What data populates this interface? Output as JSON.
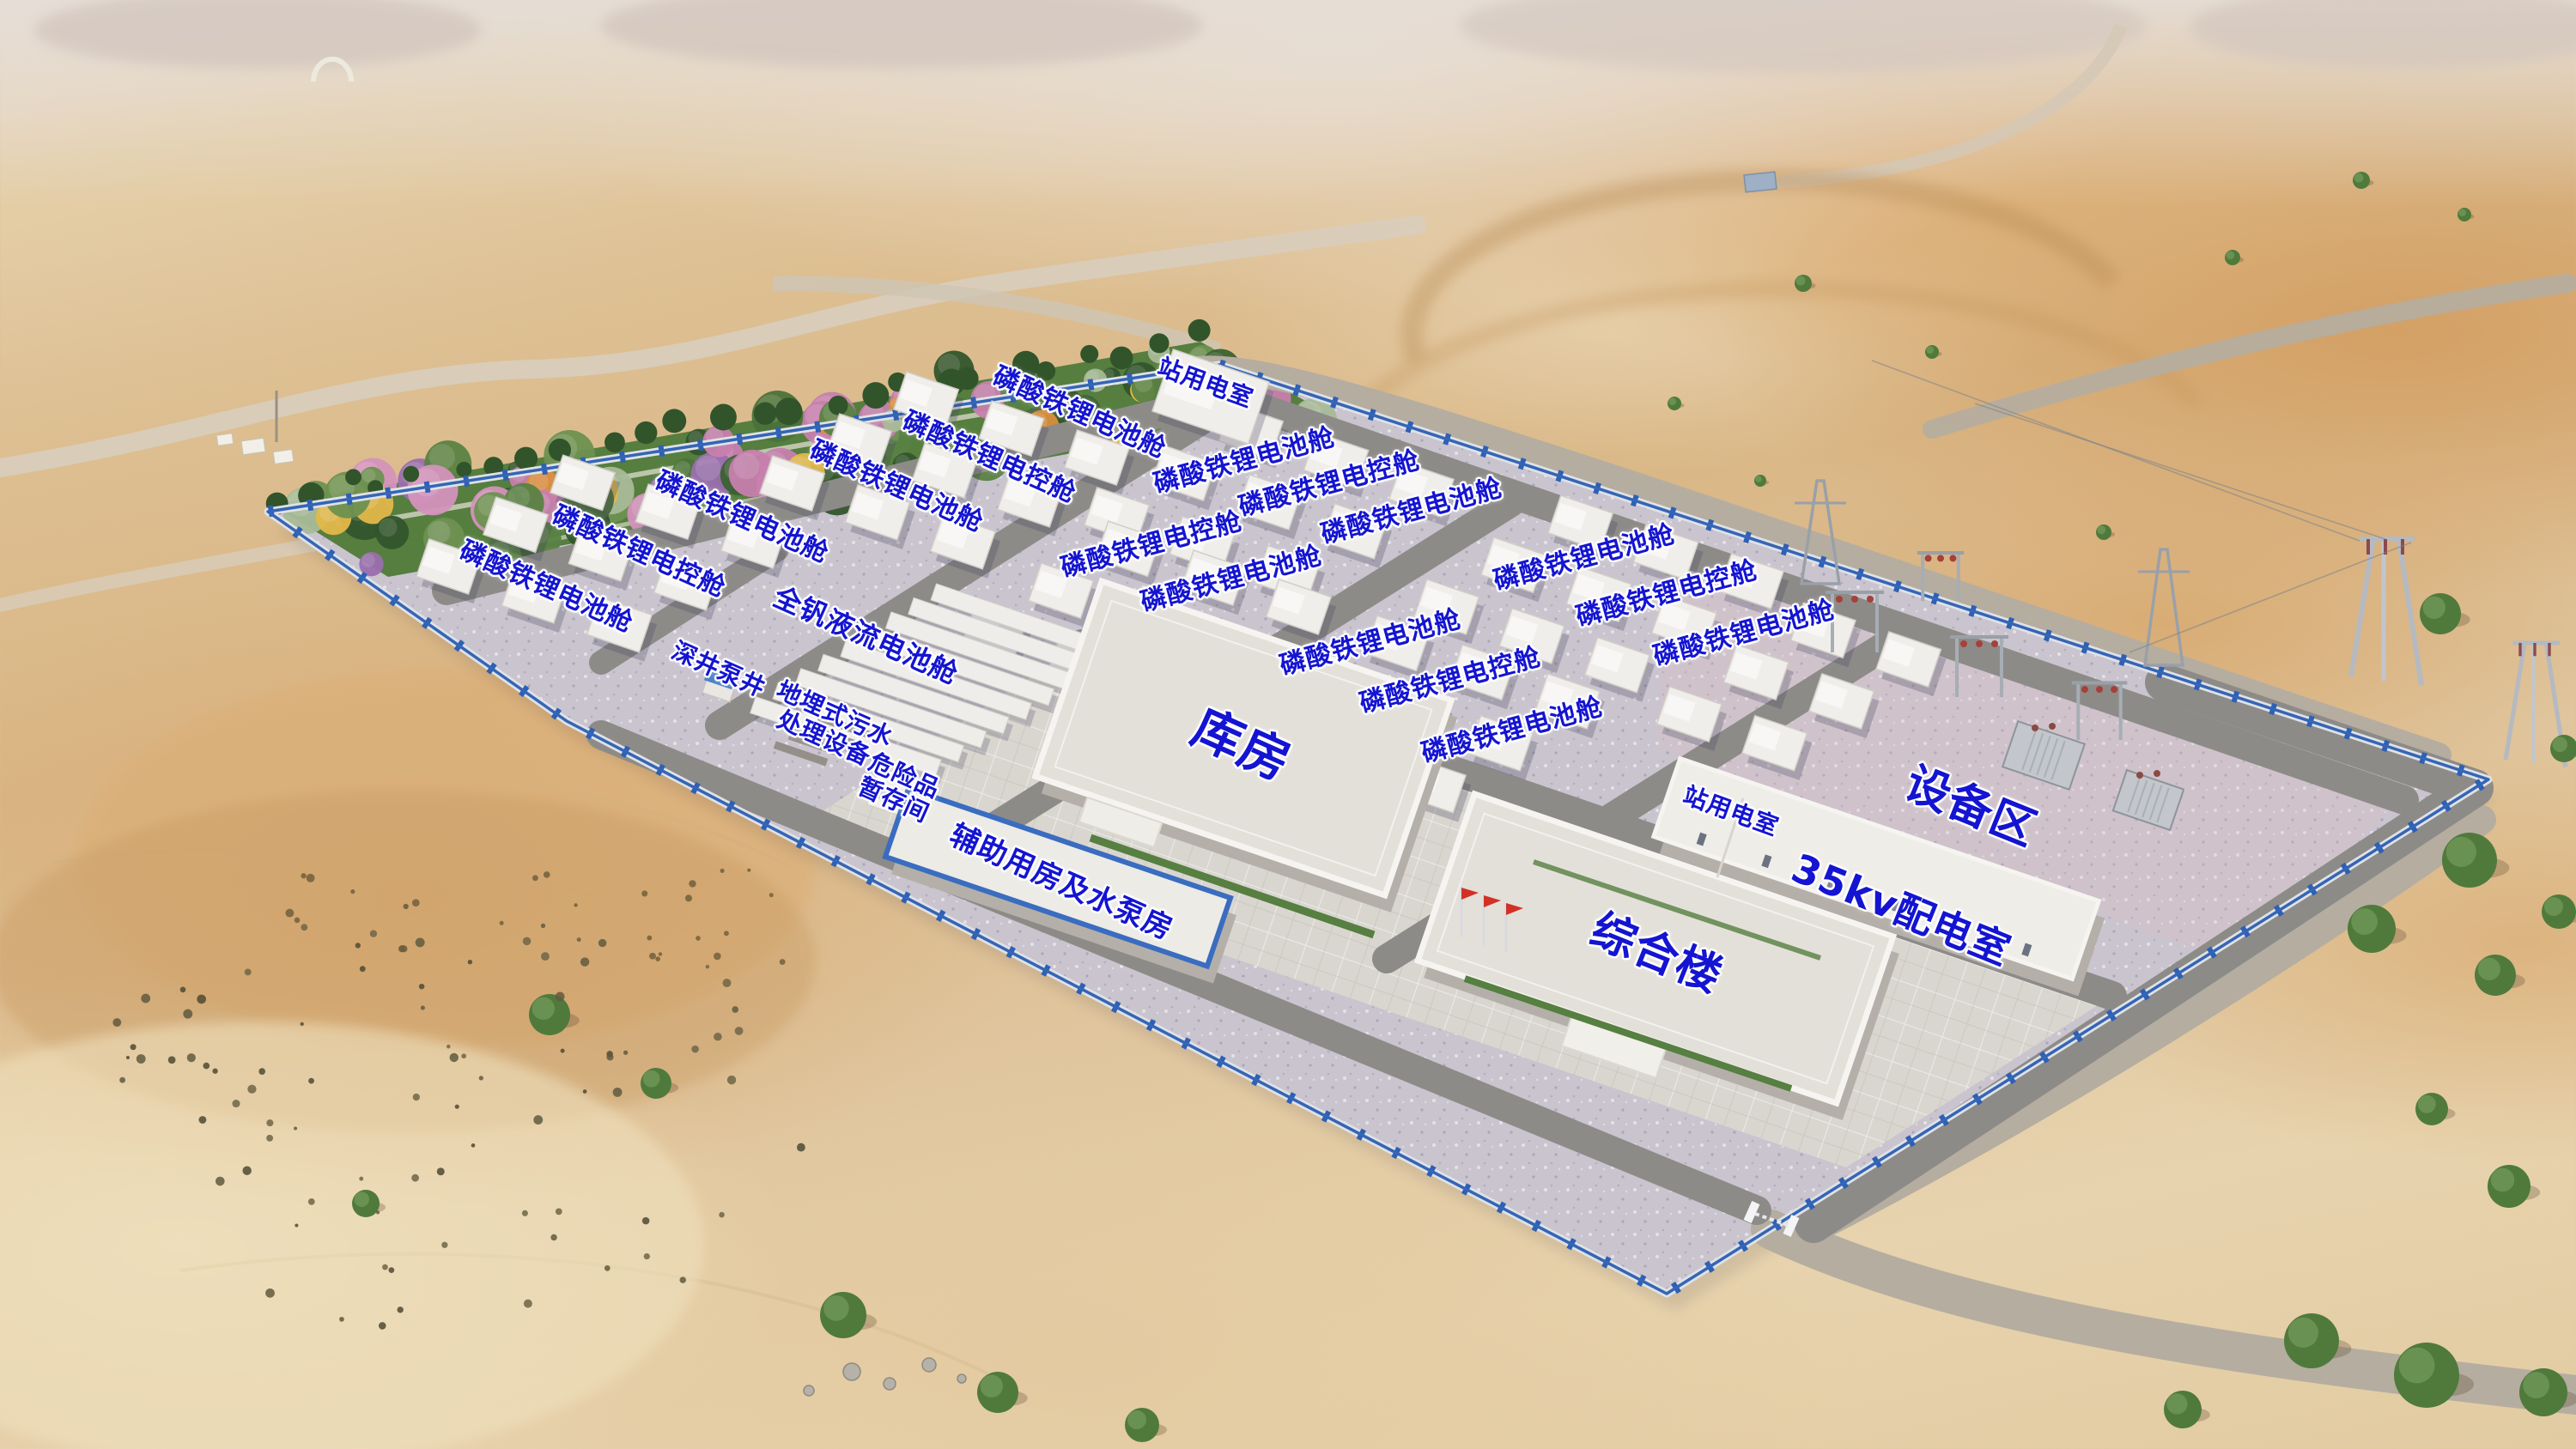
{
  "scene_type": "aerial rendering of a desert battery energy storage station",
  "colors": {
    "label_blue": "#1414d2",
    "label_outline": "#ffffff",
    "wall_blue": "#3565b5",
    "wall_panel": "#dfe2e7",
    "sand": "#ddbd8e",
    "gravel_pad": "#c9c4ce",
    "equipment_pad": "#cfc2cb",
    "road_gray": "#8d8b88",
    "plaza_concrete": "#d9d6d0",
    "container_white": "#f0eeea",
    "tree_green": "#4b7238",
    "flag_red": "#d23126"
  },
  "labels": [
    {
      "text": "站用电室",
      "x": 46.8,
      "y": 26.4,
      "rot": 20,
      "size": 28
    },
    {
      "text": "磷酸铁锂电池舱",
      "x": 41.9,
      "y": 28.5,
      "rot": 24,
      "size": 30
    },
    {
      "text": "磷酸铁锂电控舱",
      "x": 38.4,
      "y": 31.6,
      "rot": 24,
      "size": 30
    },
    {
      "text": "磷酸铁锂电池舱",
      "x": 34.8,
      "y": 33.6,
      "rot": 24,
      "size": 30
    },
    {
      "text": "磷酸铁锂电池舱",
      "x": 28.8,
      "y": 35.7,
      "rot": 24,
      "size": 30
    },
    {
      "text": "磷酸铁锂电控舱",
      "x": 24.8,
      "y": 38.1,
      "rot": 24,
      "size": 30
    },
    {
      "text": "磷酸铁锂电池舱",
      "x": 21.2,
      "y": 40.5,
      "rot": 24,
      "size": 30
    },
    {
      "text": "磷酸铁锂电池舱",
      "x": 48.3,
      "y": 31.8,
      "rot": -15,
      "size": 30
    },
    {
      "text": "磷酸铁锂电控舱",
      "x": 51.6,
      "y": 33.4,
      "rot": -15,
      "size": 30
    },
    {
      "text": "磷酸铁锂电池舱",
      "x": 54.8,
      "y": 35.3,
      "rot": -15,
      "size": 30
    },
    {
      "text": "磷酸铁锂电控舱",
      "x": 44.7,
      "y": 37.6,
      "rot": -15,
      "size": 30
    },
    {
      "text": "磷酸铁锂电池舱",
      "x": 47.8,
      "y": 40.0,
      "rot": -15,
      "size": 30
    },
    {
      "text": "磷酸铁锂电池舱",
      "x": 61.5,
      "y": 38.5,
      "rot": -15,
      "size": 30
    },
    {
      "text": "磷酸铁锂电控舱",
      "x": 64.7,
      "y": 41.0,
      "rot": -15,
      "size": 30
    },
    {
      "text": "磷酸铁锂电池舱",
      "x": 67.7,
      "y": 43.7,
      "rot": -15,
      "size": 30
    },
    {
      "text": "磷酸铁锂电池舱",
      "x": 53.2,
      "y": 44.4,
      "rot": -15,
      "size": 30
    },
    {
      "text": "磷酸铁锂电控舱",
      "x": 56.3,
      "y": 47.0,
      "rot": -15,
      "size": 30
    },
    {
      "text": "磷酸铁锂电池舱",
      "x": 58.7,
      "y": 50.4,
      "rot": -15,
      "size": 30
    },
    {
      "text": "全钒液流电池舱",
      "x": 33.6,
      "y": 43.9,
      "rot": 24,
      "size": 32
    },
    {
      "text": "深井泵井",
      "x": 27.9,
      "y": 46.2,
      "rot": 24,
      "size": 28
    },
    {
      "text": "地埋式污水\n处理设备",
      "x": 32.2,
      "y": 50.1,
      "rot": 24,
      "size": 28
    },
    {
      "text": "危险品\n暂存间",
      "x": 34.9,
      "y": 54.4,
      "rot": 24,
      "size": 28
    },
    {
      "text": "库房",
      "x": 48.2,
      "y": 51.4,
      "rot": 24,
      "size": 58
    },
    {
      "text": "辅助用房及水泵房",
      "x": 41.2,
      "y": 60.9,
      "rot": 24,
      "size": 34
    },
    {
      "text": "综合楼",
      "x": 64.3,
      "y": 65.8,
      "rot": 22,
      "size": 52
    },
    {
      "text": "站用电室",
      "x": 67.2,
      "y": 56.0,
      "rot": 20,
      "size": 28
    },
    {
      "text": "35kv配电室",
      "x": 73.8,
      "y": 62.8,
      "rot": 22,
      "size": 46
    },
    {
      "text": "设备区",
      "x": 76.5,
      "y": 55.7,
      "rot": 22,
      "size": 52
    }
  ]
}
